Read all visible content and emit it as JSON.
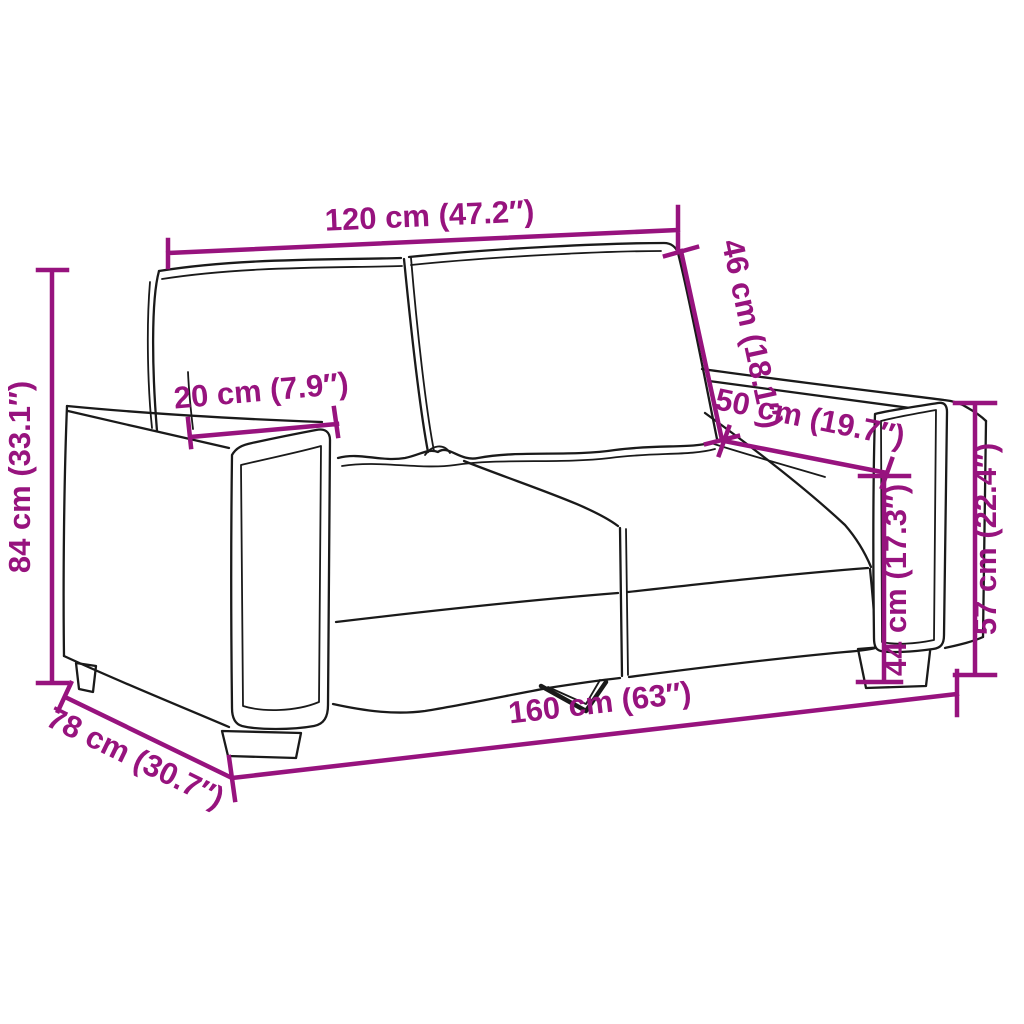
{
  "figure": {
    "kind": "product-dimension-diagram",
    "subject": "two-seater-sofa-line-art",
    "background": "#ffffff",
    "colors": {
      "dimension": "#97137E",
      "outline": "#1a1a1a"
    },
    "dimensions": [
      {
        "id": "backrest-width",
        "label": "120 cm (47.2″)",
        "cm": 120,
        "inch": 47.2
      },
      {
        "id": "backrest-height",
        "label": "46 cm (18.1″)",
        "cm": 46,
        "inch": 18.1
      },
      {
        "id": "armrest-width",
        "label": "20 cm (7.9″)",
        "cm": 20,
        "inch": 7.9
      },
      {
        "id": "armrest-length",
        "label": "50 cm (19.7″)",
        "cm": 50,
        "inch": 19.7
      },
      {
        "id": "total-height",
        "label": "84 cm (33.1″)",
        "cm": 84,
        "inch": 33.1
      },
      {
        "id": "seat-height",
        "label": "44 cm (17.3″)",
        "cm": 44,
        "inch": 17.3
      },
      {
        "id": "armrest-height",
        "label": "57 cm (22.4″)",
        "cm": 57,
        "inch": 22.4
      },
      {
        "id": "depth",
        "label": "78 cm (30.7″)",
        "cm": 78,
        "inch": 30.7
      },
      {
        "id": "total-width",
        "label": "160 cm (63″)",
        "cm": 160,
        "inch": 63
      }
    ]
  }
}
